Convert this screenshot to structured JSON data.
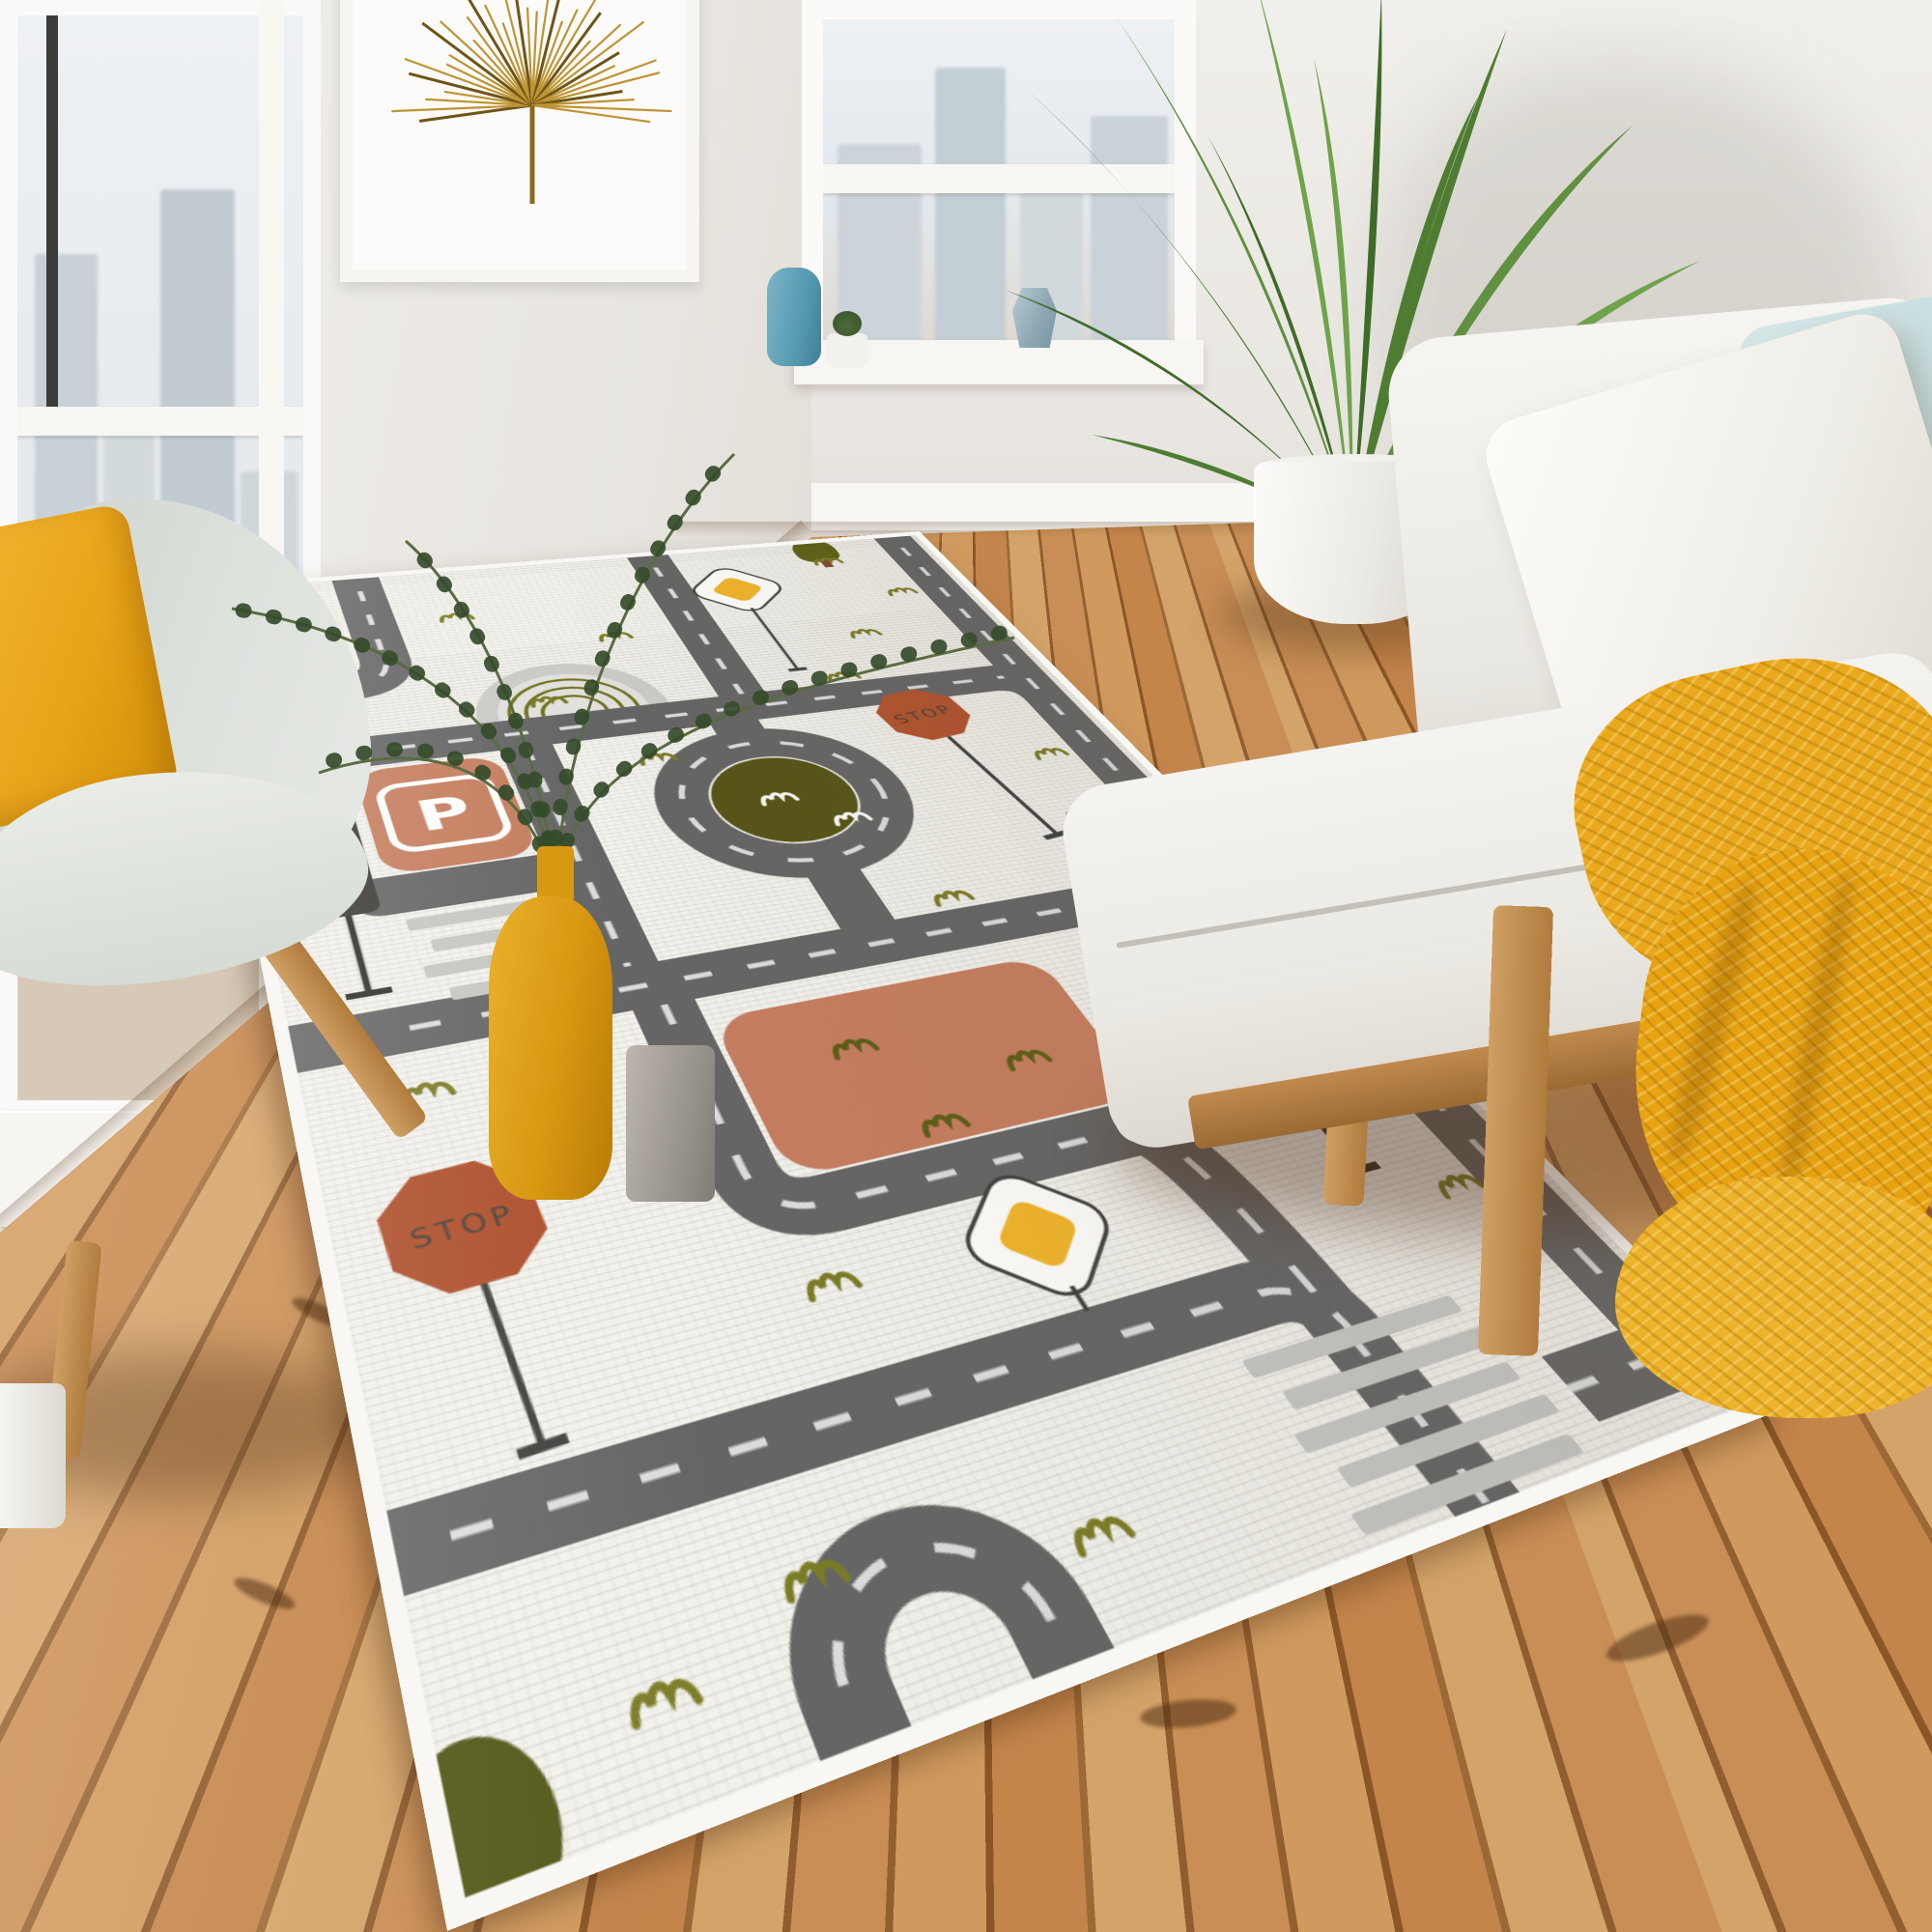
{
  "scene": {
    "subject": "kids city road play rug on wooden floor in bright living room",
    "view": "room photo, rug rotated in perspective"
  },
  "rug": {
    "labels": {
      "parking": "P",
      "stop_sign_1": "STOP",
      "stop_sign_2": "STOP"
    },
    "features": [
      "roads with white dashed center lines",
      "roundabout with olive island",
      "parking block",
      "big terracotta block",
      "two stop signs",
      "two traffic lights",
      "two yellow diamond signs",
      "two zebra crosswalks",
      "rainbow",
      "grass tufts",
      "edge trees"
    ],
    "palette": {
      "background": "#f2f1ec",
      "road": "#656565",
      "road_dash": "#dcdcdc",
      "terracotta": "#c57d5e",
      "olive": "#555416",
      "grass": "#7a7b25",
      "stop_sign": "#b0522d",
      "signal_olive": "#9a9a49",
      "signal_yellow": "#ecaa3b",
      "signal_rust": "#c05a2b",
      "diamond_yellow": "#f0b42a",
      "crosswalk": "#c6c6c3"
    }
  },
  "room": {
    "furniture": [
      "gray shell armchair with yellow pillow",
      "white daybed sofa",
      "light blue pillows",
      "mustard chunky knit throw"
    ],
    "decor": [
      "framed gold palm leaf art",
      "areca palm in white pot",
      "two windows with pale city view",
      "yellow vase with green branches",
      "gray cup",
      "blue bottle vase",
      "succulent pot",
      "faceted blue-gray vase"
    ],
    "palette": {
      "wall": "#edebe7",
      "floor_light": "#d4a369",
      "floor_dark": "#8f5d2f",
      "sofa": "#f2f1ed",
      "pillow_blue": "#cfe2e4",
      "throw_yellow": "#e9a81f",
      "chair": "#d2d7d1",
      "pillow_yellow": "#f0b42a",
      "pot_white": "#f4f3f0"
    }
  }
}
